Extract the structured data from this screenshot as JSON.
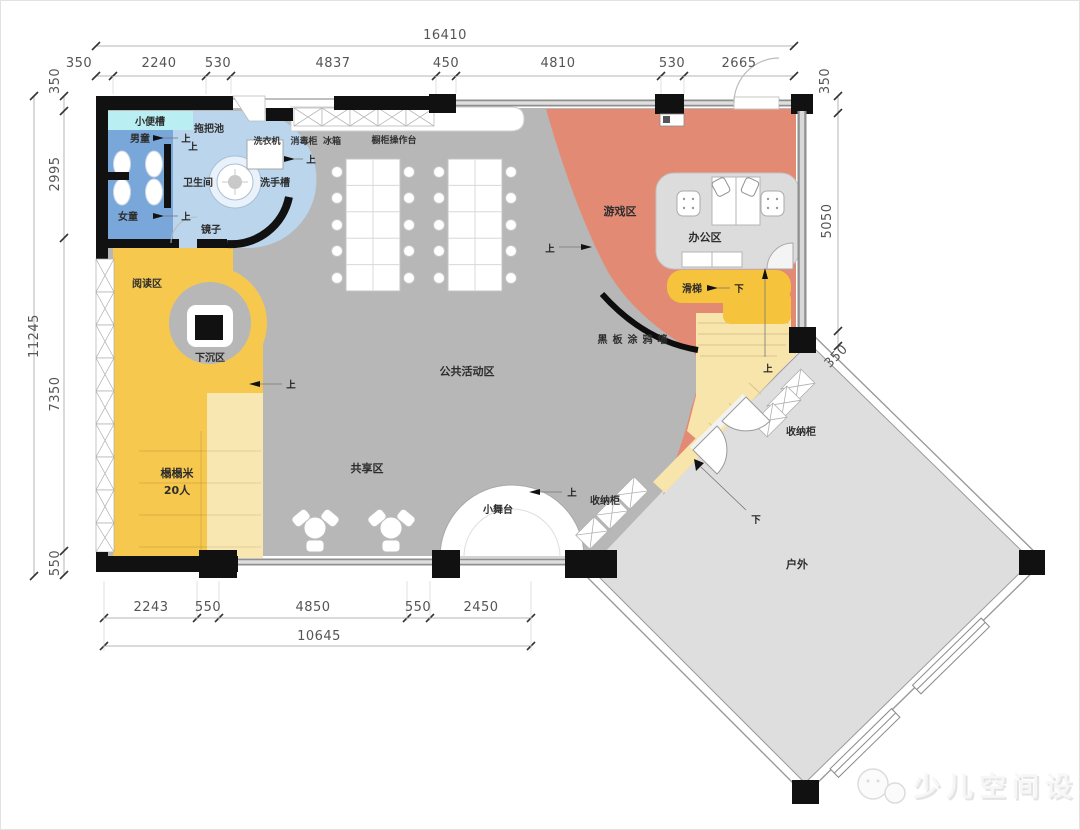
{
  "plan": {
    "rooms": {
      "urinal": "小便槽",
      "mop_pool": "拖把池",
      "boys": "男童",
      "girls": "女童",
      "bathroom": "卫生间",
      "wash_basin": "洗手槽",
      "mirror": "镜子",
      "washing_machine": "洗衣机",
      "disinfect": "消毒柜",
      "fridge": "冰箱",
      "counter": "橱柜操作台",
      "reading": "阅读区",
      "sunken": "下沉区",
      "tatami_1": "榻榻米",
      "tatami_2": "20人",
      "shared": "共享区",
      "public": "公共活动区",
      "game": "游戏区",
      "office": "办公区",
      "slide": "滑梯",
      "blackboard": "黑板涂鸦墙",
      "stage": "小舞台",
      "storage": "收纳柜",
      "outdoor": "户外"
    },
    "markers": {
      "up": "上",
      "down": "下"
    },
    "dims": {
      "top_total": "16410",
      "top": [
        "350",
        "2240",
        "530",
        "4837",
        "450",
        "4810",
        "530",
        "2665"
      ],
      "right": [
        "350",
        "5050",
        "350"
      ],
      "left_total": "11245",
      "left": [
        "350",
        "2995",
        "7350",
        "550"
      ],
      "bottom": [
        "2243",
        "550",
        "4850",
        "550",
        "2450"
      ],
      "bottom_total": "10645"
    },
    "watermark": "少儿空间设计",
    "colors": {
      "floor": "#b7b7b7",
      "outdoor_floor": "#dedede",
      "game_red": "#e38a74",
      "play_yellow": "#f6c84e",
      "pale_yellow": "#f8e5ac",
      "slide_yellow": "#f6c33c",
      "toilet_blue": "#7aa7d9",
      "bath_blue": "#bad5ec",
      "urinal_cyan": "#b9eef2",
      "office_gray": "#dcdcdc",
      "wall_black": "#111111"
    }
  }
}
